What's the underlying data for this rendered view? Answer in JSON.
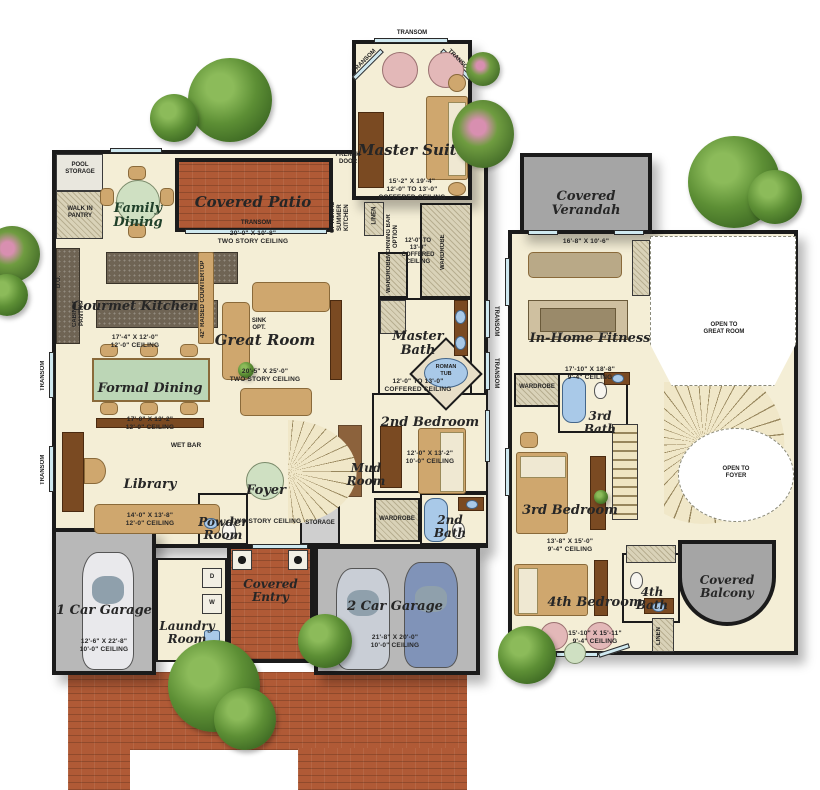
{
  "meta": {
    "type": "two-story floor plan",
    "floors_shown": 2
  },
  "colors": {
    "wall": "#1b1b1b",
    "floor": "#f4eed6",
    "brick": "#b05a36",
    "garage": "#b8b8b8",
    "verandah": "#a8a8a8",
    "window": "#cfe9f0",
    "tub": "#a9c9e8",
    "tree": "#4e7d2d"
  },
  "rooms": {
    "master_suite": {
      "name": "Master Suite",
      "sub": "15'-2\" X 19'-4\"\n12'-0\" TO 13'-0\"\nCOFFERED CEILING"
    },
    "covered_patio": {
      "name": "Covered Patio",
      "sub": "20'-0\" X 10'-8\"\nTWO STORY CEILING"
    },
    "family_dining": {
      "name": "Family\nDining",
      "sub": ""
    },
    "gourmet_kitchen": {
      "name": "Gourmet Kitchen",
      "sub": "17'-4\" X 12'-0\"\n12'-0\" CEILING"
    },
    "great_room": {
      "name": "Great Room",
      "sub": "20'-5\" X 25'-0\"\nTWO STORY CEILING"
    },
    "master_bath": {
      "name": "Master\nBath",
      "sub": "12'-0\" TO 13'-0\"\nCOFFERED CEILING"
    },
    "formal_dining": {
      "name": "Formal Dining",
      "sub": "17'-0\" X 13'-2\"\n12'-0\" CEILING"
    },
    "library": {
      "name": "Library",
      "sub": "14'-0\" X 13'-8\"\n12'-0\" CEILING"
    },
    "foyer": {
      "name": "Foyer",
      "sub": "TWO STORY CEILING"
    },
    "mud_room": {
      "name": "Mud\nRoom",
      "sub": ""
    },
    "powder_room": {
      "name": "Powder\nRoom",
      "sub": ""
    },
    "bedroom_2": {
      "name": "2nd Bedroom",
      "sub": "12'-0\" X 13'-2\"\n10'-0\" CEILING"
    },
    "bath_2": {
      "name": "2nd\nBath",
      "sub": ""
    },
    "garage_1": {
      "name": "1 Car Garage",
      "sub": "12'-6\" X 22'-8\"\n10'-0\" CEILING"
    },
    "laundry_room": {
      "name": "Laundry\nRoom",
      "sub": ""
    },
    "covered_entry": {
      "name": "Covered\nEntry",
      "sub": ""
    },
    "garage_2": {
      "name": "2 Car Garage",
      "sub": "21'-8\" X 20'-0\"\n10'-0\" CEILING"
    },
    "covered_verandah": {
      "name": "Covered\nVerandah",
      "sub": "16'-8\" X 10'-6\""
    },
    "in_home_fitness": {
      "name": "In-Home Fitness",
      "sub": "17'-10\" X 18'-8\"\n9'-4\" CEILING"
    },
    "bath_3": {
      "name": "3rd\nBath",
      "sub": ""
    },
    "bedroom_3": {
      "name": "3rd Bedroom",
      "sub": "13'-8\" X 15'-0\"\n9'-4\" CEILING"
    },
    "bedroom_4": {
      "name": "4th Bedroom",
      "sub": "15'-10\" X 15'-11\"\n9'-4\" CEILING"
    },
    "bath_4": {
      "name": "4th\nBath",
      "sub": ""
    },
    "covered_balcony": {
      "name": "Covered\nBalcony",
      "sub": ""
    }
  },
  "labels": {
    "transom": "TRANSOM",
    "pool_storage": "POOL\nSTORAGE",
    "walk_in_pantry": "WALK IN\nPANTRY",
    "french_door": "FRENCH\nDOOR",
    "optional_summer_kitchen": "OPTIONAL\nSUMMER\nKITCHEN",
    "linen": "LINEN",
    "morning_bar_option": "MORNING BAR\nOPTION",
    "coffered_note": "12'-0\" TO\n13'-0\"\nCOFFERED\nCEILING",
    "wardrobe": "WARDROBE",
    "sink_opt": "SINK\nOPT.",
    "do": "D.O.",
    "cabinet_pantry": "CABINET\nPANTRY",
    "raised_countertop": "42\" RAISED COUNTERTOP",
    "roman_tub": "ROMAN\nTUB",
    "wet_bar": "WET BAR",
    "storage": "STORAGE",
    "dryer": "D",
    "washer": "W",
    "open_to_great_room": "OPEN TO\nGREAT ROOM",
    "open_to_foyer": "OPEN TO\nFOYER"
  }
}
